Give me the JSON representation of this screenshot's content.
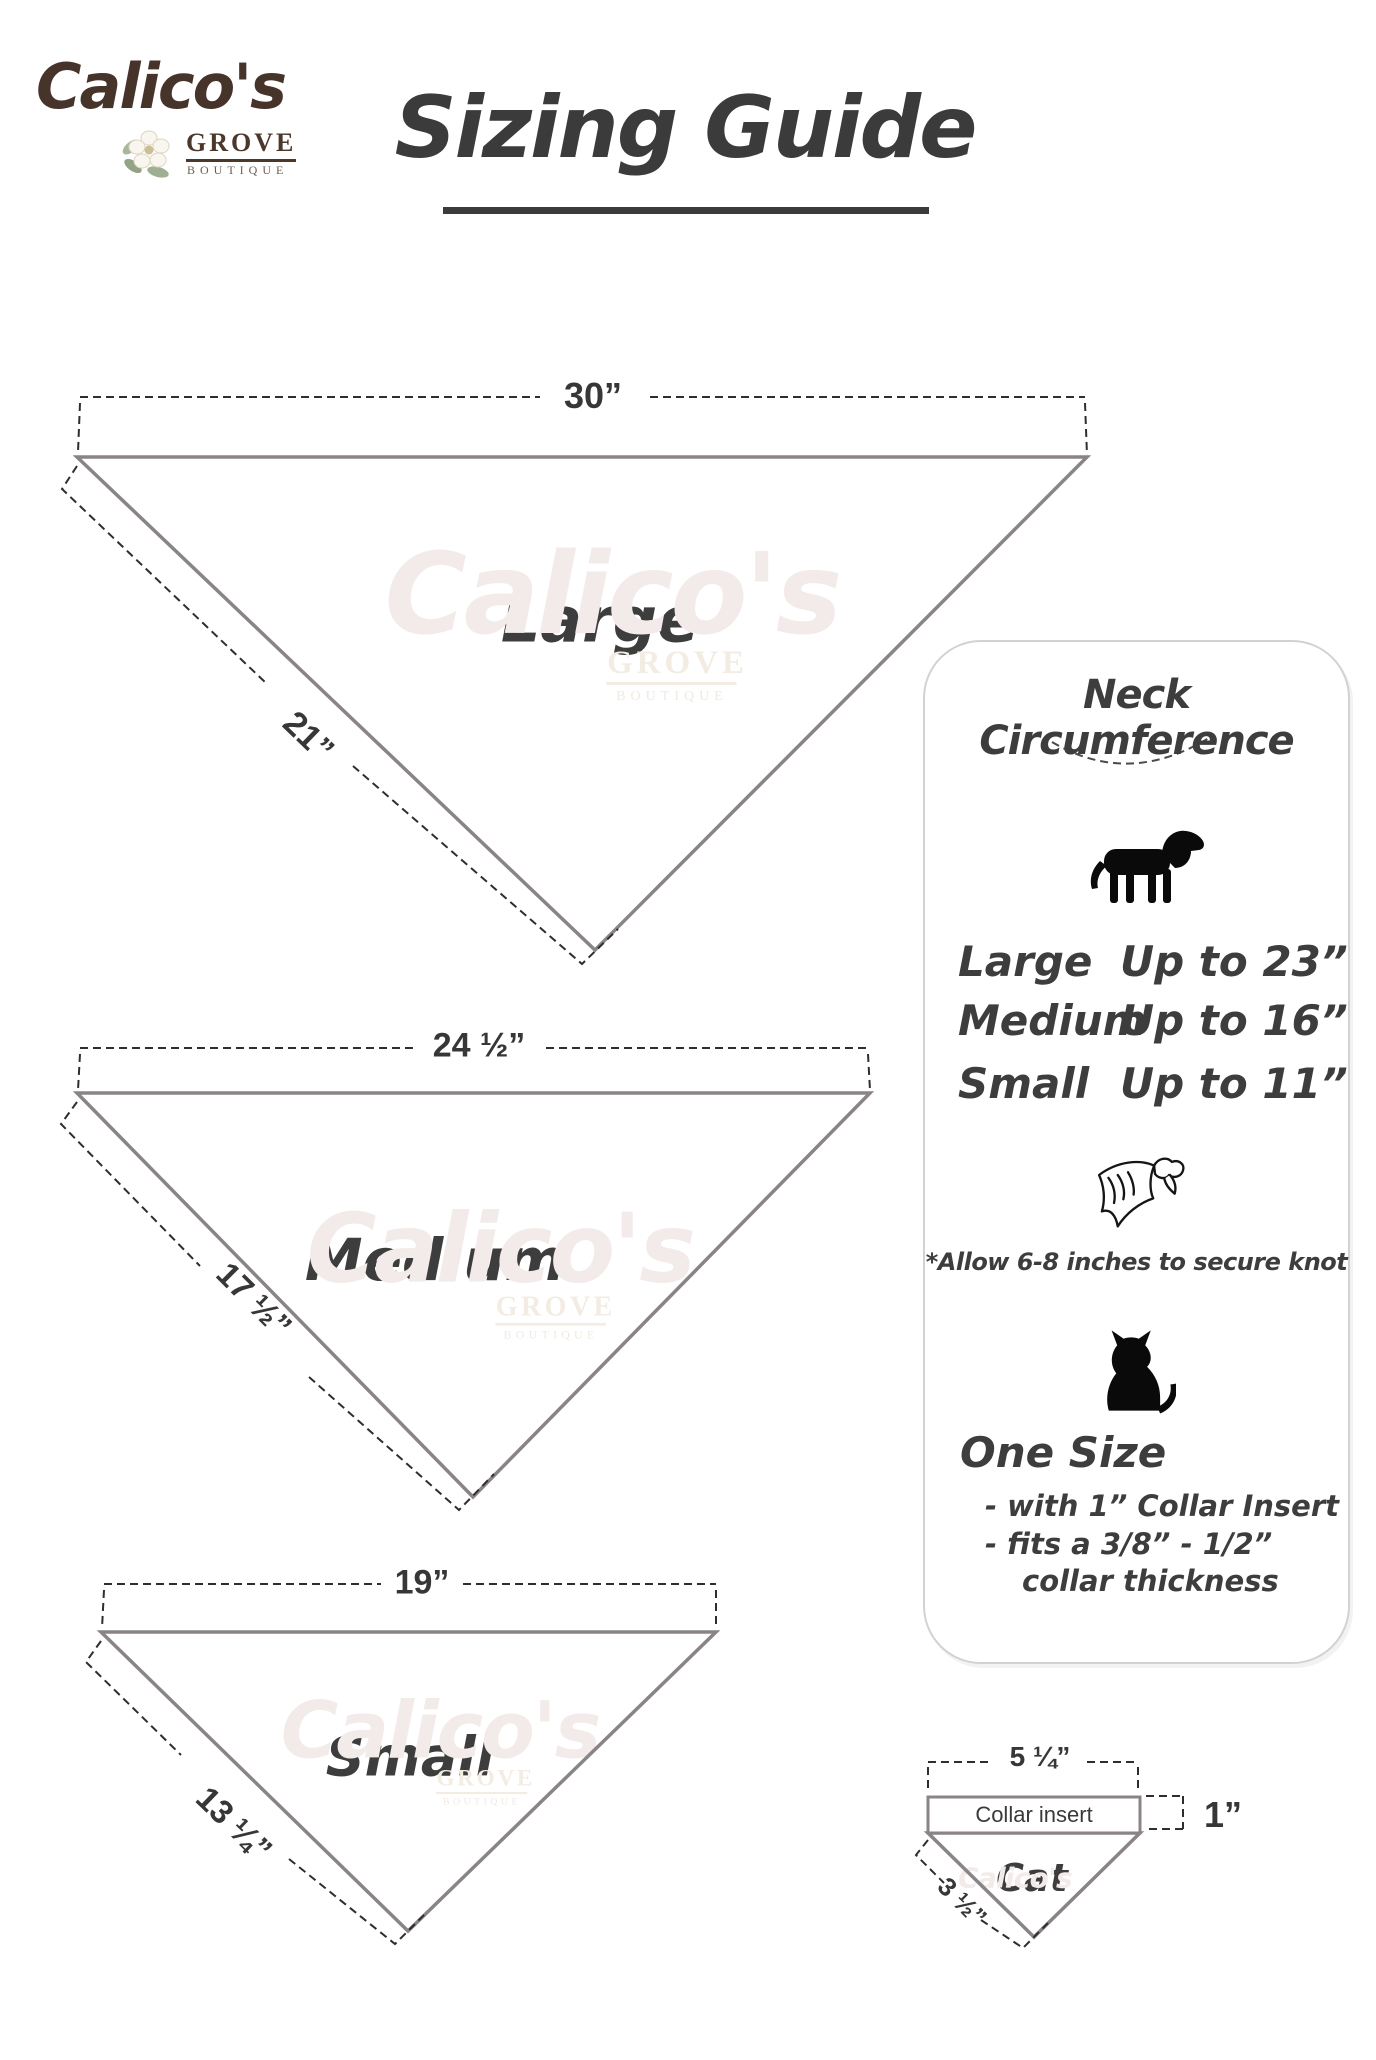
{
  "logo": {
    "name": "Calico's",
    "grove": "GROVE",
    "boutique": "BOUTIQUE"
  },
  "title": {
    "text": "Sizing Guide"
  },
  "bandanas": [
    {
      "size_label": "Large",
      "top_width": "30”",
      "side_length": "21”"
    },
    {
      "size_label": "Medium",
      "top_width": "24 ½”",
      "side_length": "17 ½”"
    },
    {
      "size_label": "Small",
      "top_width": "19”",
      "side_length": "13 ¼”"
    }
  ],
  "panel": {
    "heading": "Neck Circumference",
    "rows": [
      {
        "size": "Large",
        "value": "Up to 23”"
      },
      {
        "size": "Medium",
        "value": "Up to 16”"
      },
      {
        "size": "Small",
        "value": "Up to 11”"
      }
    ],
    "knot_note": "*Allow 6-8 inches to secure knot",
    "one_size_heading": "One Size",
    "one_size_line1": "- with 1” Collar Insert",
    "one_size_line2": "- fits a 3/8” - 1/2”",
    "one_size_line3": "collar thickness"
  },
  "cat_diagram": {
    "top_width": "5 ¼”",
    "insert_label": "Collar insert",
    "insert_height": "1”",
    "side_length": "3 ½”",
    "size_label": "Cat"
  },
  "icons": {
    "dog": "dog-icon",
    "bandana": "bandana-icon",
    "cat": "cat-icon",
    "flower": "flower-icon"
  },
  "colors": {
    "triangle_line": "#8a8487",
    "dashed_line": "#2e2e2e",
    "script_text": "#3d3d3d",
    "logo_brown": "#46332a",
    "panel_border": "#d2d2d2",
    "watermark": "#f3ebea"
  }
}
